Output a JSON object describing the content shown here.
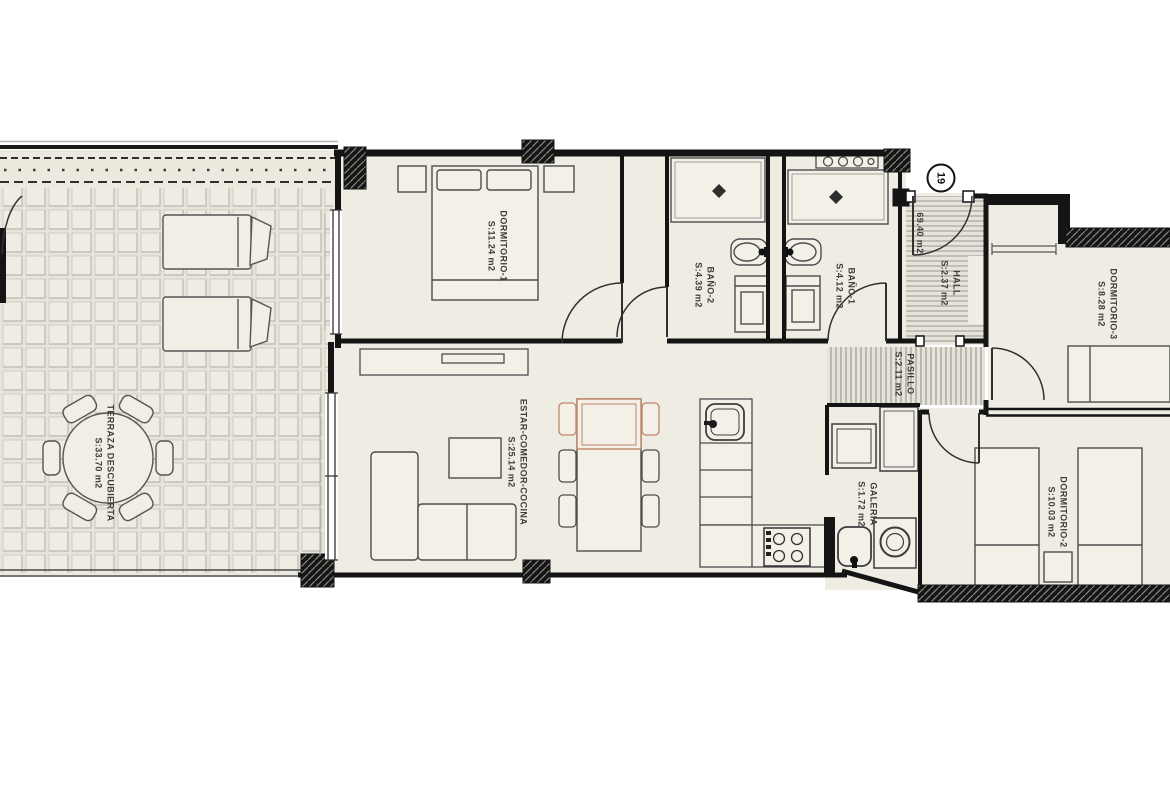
{
  "plan": {
    "unit_number": "19",
    "total_area_label": "69.40 m2",
    "rooms": [
      {
        "id": "terraza-descubierta",
        "name": "TERRAZA DESCUBIERTA",
        "area": "S:33.70 m2"
      },
      {
        "id": "dormitorio-1",
        "name": "DORMITORIO-1",
        "area": "S:11.24 m2"
      },
      {
        "id": "bano-2",
        "name": "BAÑO-2",
        "area": "S:4.39 m2"
      },
      {
        "id": "bano-1",
        "name": "BAÑO-1",
        "area": "S:4.12 m2"
      },
      {
        "id": "hall",
        "name": "HALL",
        "area": "S:2.37 m2"
      },
      {
        "id": "pasillo",
        "name": "PASILLO",
        "area": "S:2.11 m2"
      },
      {
        "id": "dormitorio-3",
        "name": "DORMITORIO-3",
        "area": "S:8.28 m2"
      },
      {
        "id": "estar-comedor-cocina",
        "name": "ESTAR-COMEDOR-COCINA",
        "area": "S:25.14 m2"
      },
      {
        "id": "galeria",
        "name": "GALERIA",
        "area": "S:1.72 m2"
      },
      {
        "id": "dormitorio-2",
        "name": "DORMITORIO-2",
        "area": "S:10.03 m2"
      }
    ],
    "colors": {
      "wall": "#141414",
      "floor": "#efece4",
      "accent": "#bf8569"
    }
  }
}
